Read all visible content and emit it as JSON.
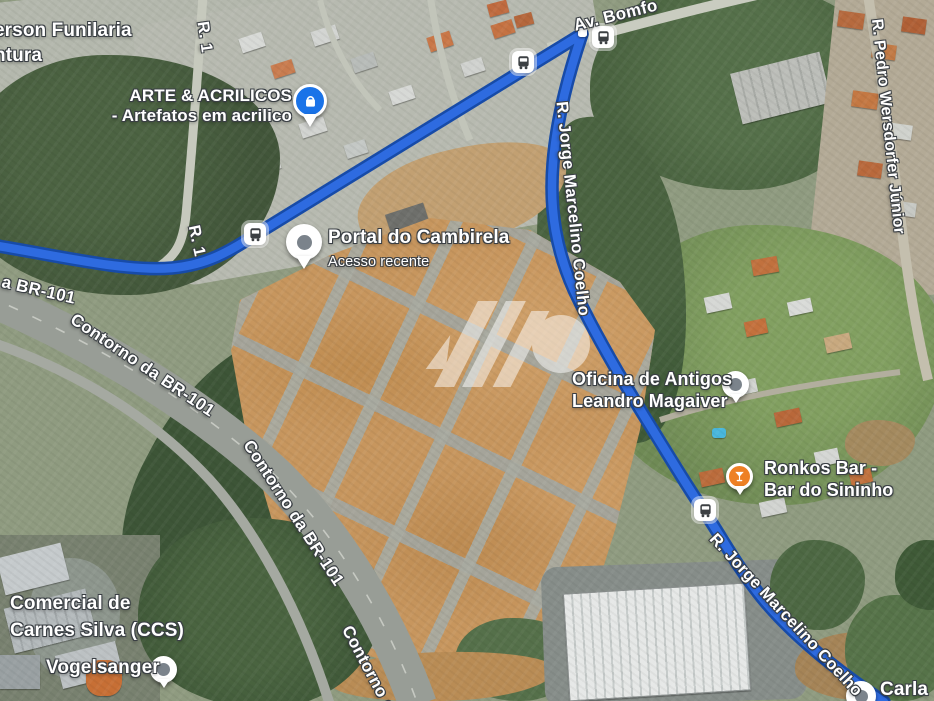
{
  "map_type": "satellite-navigation-map",
  "colors": {
    "route": "#2e6be0",
    "route_casing": "#174ba8",
    "pin_blue": "#1a73e8",
    "pin_orange": "#ee8024",
    "pin_neutral_dot": "#7b838b",
    "bus_glyph": "#3c4043"
  },
  "roads": [
    {
      "id": "r1-a",
      "text": "R. 1"
    },
    {
      "id": "r1-b",
      "text": "R. 1"
    },
    {
      "id": "av-bomfo",
      "text": "Av. Bomfo"
    },
    {
      "id": "br101-fragment",
      "text": "a BR-101"
    },
    {
      "id": "contorno-a",
      "text": "Contorno da BR-101"
    },
    {
      "id": "contorno-b",
      "text": "Contorno da BR-101"
    },
    {
      "id": "contorno-c",
      "text": "Contorno d"
    },
    {
      "id": "jorge-a",
      "text": "R. Jorge Marcelino Coelho"
    },
    {
      "id": "jorge-b",
      "text": "R. Jorge Marcelino Coelho"
    },
    {
      "id": "pedro",
      "text": "R. Pedro Wersdorfer Júnior"
    }
  ],
  "pois": [
    {
      "line1": "erson Funilaria",
      "line2": "ntura"
    },
    {
      "line1": "ARTE & ACRILICOS",
      "line2": "- Artefatos em acrilico",
      "marker": "shopping-pin"
    },
    {
      "line1": "Portal do Cambirela",
      "line2": "Acesso recente",
      "marker": "recent-place-pin"
    },
    {
      "line1": "Oficina de Antigos",
      "line2": "Leandro Magaiver",
      "marker": "place-pin"
    },
    {
      "line1": "Ronkos Bar -",
      "line2": "Bar do Sininho",
      "marker": "bar-pin"
    },
    {
      "line1": "Comercial de",
      "line2": "Carnes Silva (CCS)"
    },
    {
      "line1": "Vogelsanger",
      "marker": "place-dot"
    },
    {
      "line1": "Carla",
      "marker": "place-dot"
    }
  ],
  "transit": {
    "bus_stop_count": 4,
    "icon": "bus-stop"
  }
}
